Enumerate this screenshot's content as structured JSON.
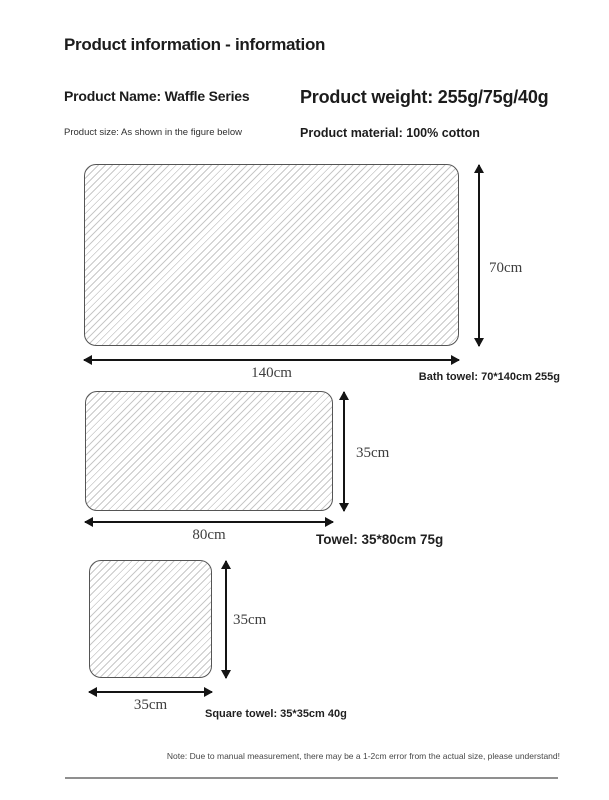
{
  "page": {
    "title": "Product information - information",
    "info": {
      "name": "Product Name: Waffle Series",
      "weight": "Product weight: 255g/75g/40g",
      "size_note": "Product size: As shown in the figure below",
      "material": "Product material: 100% cotton"
    },
    "diagrams": [
      {
        "item": "bath-towel",
        "width_label": "140cm",
        "height_label": "70cm",
        "caption": "Bath towel: 70*140cm 255g"
      },
      {
        "item": "towel",
        "width_label": "80cm",
        "height_label": "35cm",
        "caption": "Towel: 35*80cm 75g"
      },
      {
        "item": "square-towel",
        "width_label": "35cm",
        "height_label": "35cm",
        "caption": "Square towel: 35*35cm 40g"
      }
    ],
    "footnote": "Note: Due to manual measurement, there may be a 1-2cm error from the actual size, please understand!",
    "colors": {
      "ink": "#1c1c1c",
      "dimlabel": "#3f3f3f",
      "hatch": "#c8c8c8",
      "outline": "#555555",
      "divider": "#8f8f8f",
      "arrow": "#141414"
    }
  }
}
